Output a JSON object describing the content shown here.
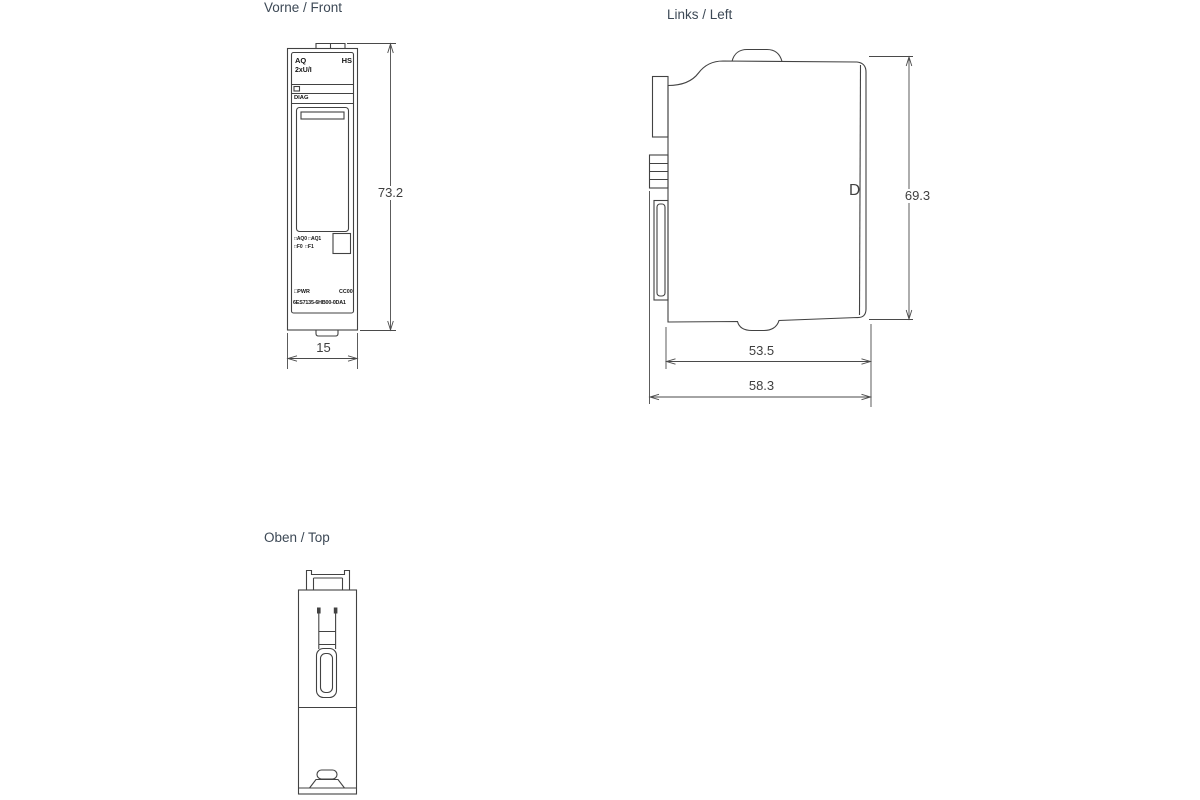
{
  "views": {
    "front": {
      "title": "Vorne / Front"
    },
    "left": {
      "title": "Links / Left"
    },
    "top": {
      "title": "Oben / Top"
    }
  },
  "front_module": {
    "type_label": "AQ",
    "class_label": "HS",
    "channels_label": "2xU/I",
    "diag_label": "DIAG",
    "led_row1": "□AQ0 □AQ1",
    "led_row2": "□F0  □F1",
    "pwr_label": "□PWR",
    "coding_label": "CC00",
    "article_number": "6ES7135-6HB00-0DA1"
  },
  "left_module": {
    "housing_letter": "D"
  },
  "dimensions": {
    "front_height_mm": "73.2",
    "front_width_mm": "15",
    "left_height_mm": "69.3",
    "left_depth_inner_mm": "53.5",
    "left_depth_total_mm": "58.3"
  },
  "colors": {
    "line": "#424242",
    "title_text": "#3d4956",
    "dimension_text": "#3f3f3f",
    "background": "#ffffff"
  }
}
